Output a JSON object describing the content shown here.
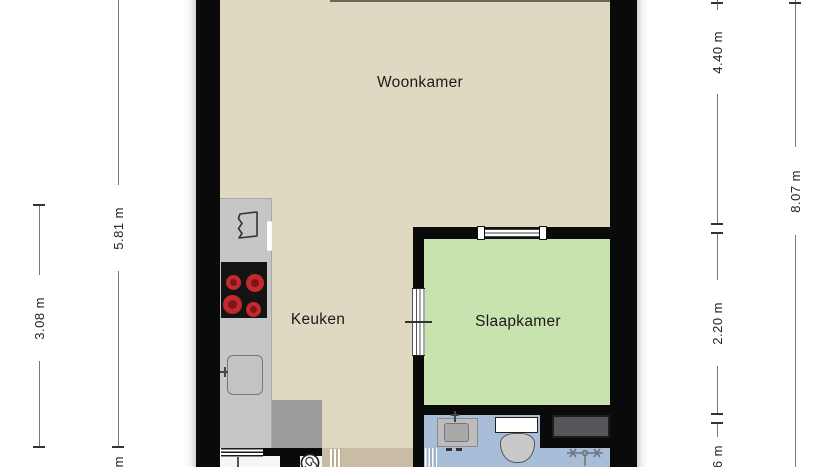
{
  "plan_type": "floorplan",
  "rooms": {
    "woonkamer": {
      "label": "Woonkamer",
      "floor_color": "#E0D9C2"
    },
    "keuken": {
      "label": "Keuken",
      "floor_color": "#E0D9C2"
    },
    "slaapkamer": {
      "label": "Slaapkamer",
      "floor_color": "#C9E3AF"
    },
    "badkamer": {
      "floor_color": "#A7BDD8"
    },
    "hal": {
      "floor_color": "#C8BCA4"
    }
  },
  "dimensions": {
    "left_outer": {
      "label": "5.81 m"
    },
    "left_inner": {
      "label": "3.08 m"
    },
    "left_bottom_partial": {
      "label": "m"
    },
    "right_top": {
      "label": "4.40 m"
    },
    "right_middle": {
      "label": "2.20 m"
    },
    "right_bottom_partial": {
      "label": "6 m"
    },
    "right_outer": {
      "label": "8.07 m"
    }
  },
  "colors": {
    "background": "#FFFFFF",
    "wall": "#0A0A0A",
    "floor_living": "#E0D9C2",
    "floor_bedroom": "#C9E3AF",
    "floor_bathroom": "#A7BDD8",
    "floor_hall": "#C8BCA4",
    "counter": "#C6C6C6",
    "appliance_dark": "#9B9B9B",
    "cooktop": "#141414",
    "burner_red": "#C3292D",
    "storage_unit": "#55555A",
    "dimension_line": "#777777",
    "dimension_text": "#222222"
  },
  "icons": {
    "extractor_hood": "zigzag-edged outline polygon on counter",
    "cooktop": "black square with 4 red burners",
    "kitchen_sink": "rounded square with tap mark",
    "washbasin": "grey cabinet with basin and tap",
    "toilet": "cistern rectangle with oval bowl",
    "shower_tap": "crossed-handle faucet glyph",
    "drain_spiral": "circle with spiral"
  }
}
